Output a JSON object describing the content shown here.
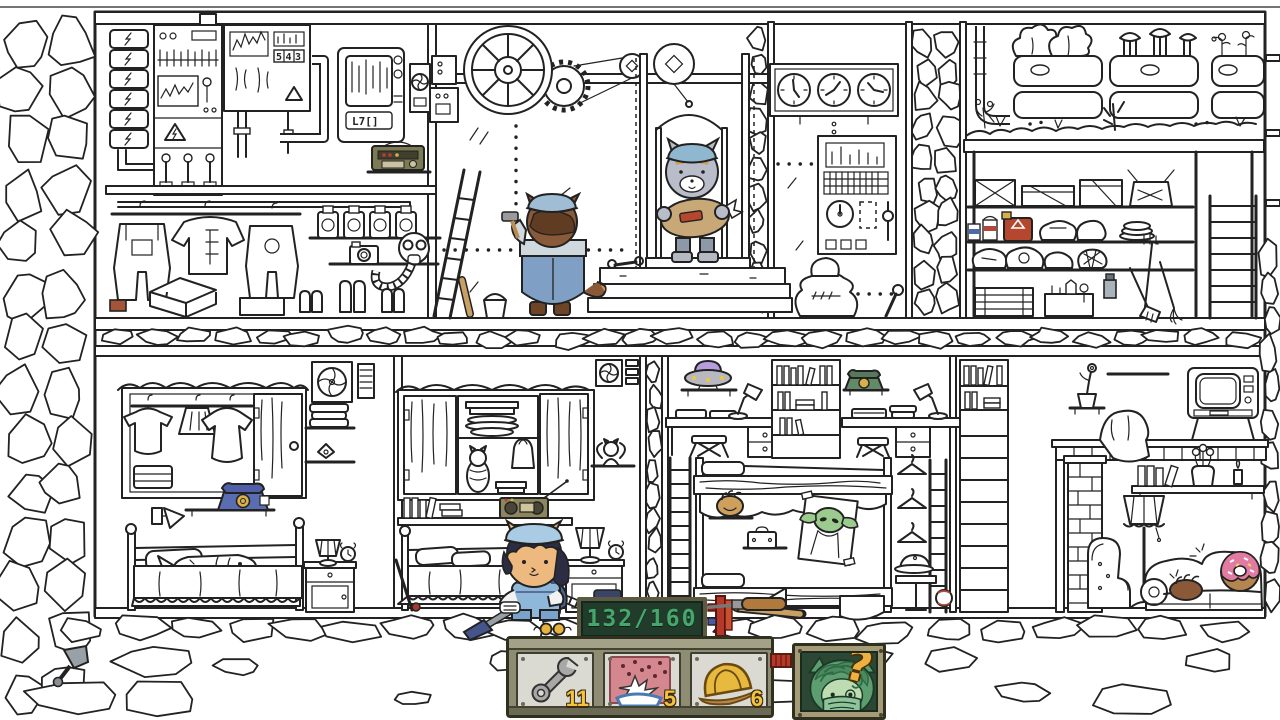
{
  "hud": {
    "counter_value": "132/160",
    "slots": [
      {
        "id": "wrench",
        "icon": "wrench-icon",
        "count": "11"
      },
      {
        "id": "bait",
        "icon": "water-splash-icon",
        "count": "5"
      },
      {
        "id": "helmet",
        "icon": "hard-hat-icon",
        "count": "6"
      }
    ],
    "hint_symbol": "?"
  },
  "scene": {
    "breaker_display": "543",
    "terminal_display": "L7[]"
  },
  "palette": {
    "ink": "#222222",
    "counter_green": "#45a76c",
    "board_bg": "#223c2c",
    "toolbox_olive": "#8e8d73",
    "plate_gray": "#dbdad2",
    "count_yellow": "#f5c43e",
    "hint_bg": "#2c4834",
    "hint_face_green": "#5d9e71",
    "question_orange": "#edb042",
    "connector_red": "#b23b2b"
  }
}
